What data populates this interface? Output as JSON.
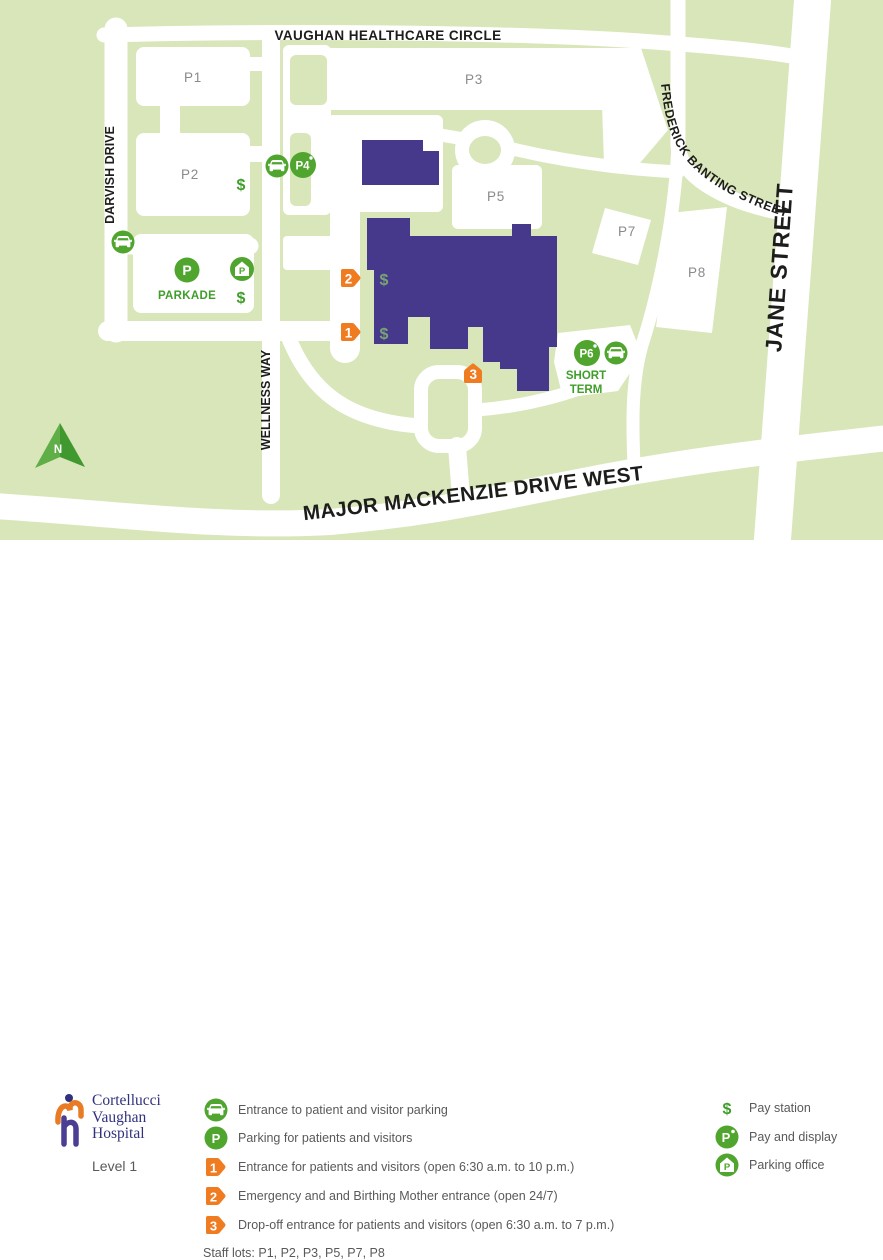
{
  "symbols": {
    "dollar": "$",
    "p": "P",
    "north": "N",
    "one": "1",
    "two": "2",
    "three": "3",
    "p4": "P4",
    "p6": "P6"
  },
  "map": {
    "roads": {
      "vaughan_healthcare_circle": "VAUGHAN HEALTHCARE CIRCLE",
      "darvish_drive": "DARVISH DRIVE",
      "wellness_way": "WELLNESS WAY",
      "frederick_banting_street": "FREDERICK BANTING STREET",
      "jane_street": "JANE STREET",
      "major_mackenzie_drive_west": "MAJOR MACKENZIE DRIVE WEST"
    },
    "lots": {
      "p1": "P1",
      "p2": "P2",
      "p3": "P3",
      "p5": "P5",
      "p7": "P7",
      "p8": "P8"
    },
    "labels": {
      "parkade": "PARKADE",
      "short_line1": "SHORT",
      "short_line2": "TERM"
    }
  },
  "legend": {
    "logo": {
      "line1": "Cortellucci",
      "line2": "Vaughan",
      "line3": "Hospital",
      "level": "Level 1"
    },
    "items_left": [
      {
        "label": "Entrance to patient and visitor parking"
      },
      {
        "label": "Parking for patients and visitors"
      },
      {
        "label": "Entrance for patients and visitors (open 6:30 a.m. to 10 p.m.)"
      },
      {
        "label": "Emergency and and Birthing Mother entrance (open 24/7)"
      },
      {
        "label": "Drop-off entrance for patients and visitors (open 6:30 a.m. to 7 p.m.)"
      }
    ],
    "staff_lots": "Staff lots: P1, P2, P3, P5, P7, P8",
    "items_right": [
      {
        "label": "Pay station"
      },
      {
        "label": "Pay and display"
      },
      {
        "label": "Parking office"
      }
    ]
  },
  "colors": {
    "background_green": "#d8e6ba",
    "road_white": "#ffffff",
    "building_purple": "#46398c",
    "icon_green": "#4fa52e",
    "marker_orange": "#f07c22",
    "lot_label_gray": "#8a8a8a",
    "legend_text_gray": "#58595b",
    "logo_navy": "#31317f"
  }
}
